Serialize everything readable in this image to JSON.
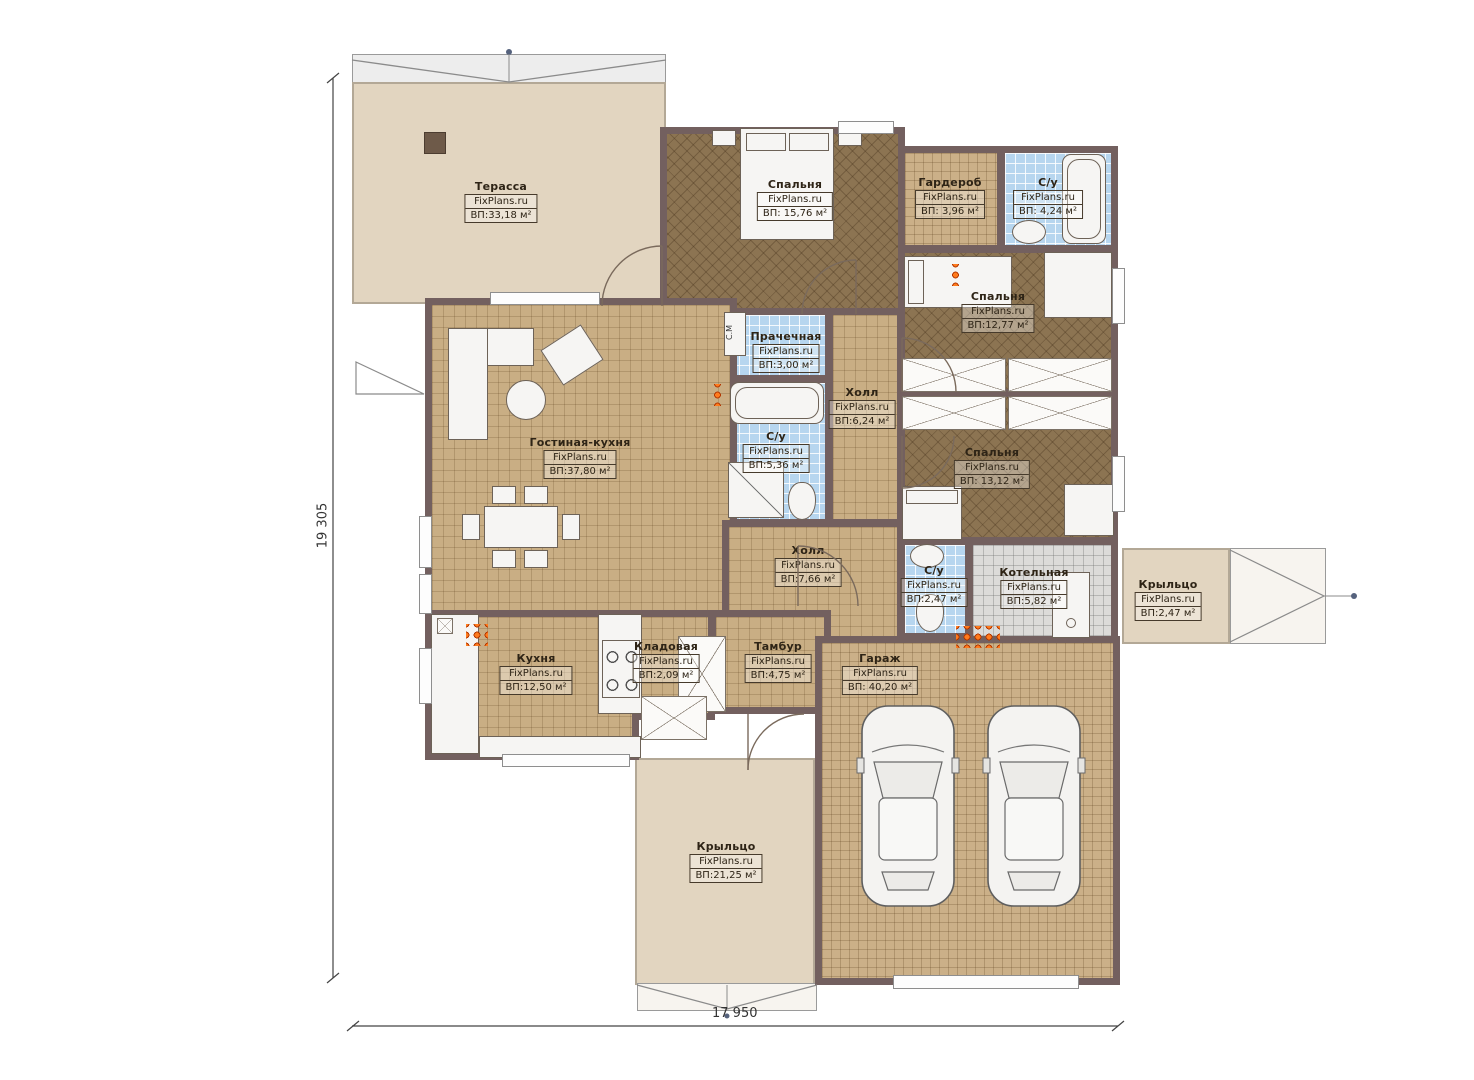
{
  "brand": "FixPlans.ru",
  "dimensions": {
    "height_label": "19 305",
    "width_label": "17 950"
  },
  "annotations": {
    "washing_machine": "С.М"
  },
  "colors": {
    "wall": "#73605f",
    "floor_tile": "#c9ae84",
    "floor_bedroom": "#8c7452",
    "floor_bath": "#b7d6ef",
    "floor_terrace": "#e2d5c0",
    "floor_boiler": "#dcdbd9",
    "radiator": "#ff7b1d"
  },
  "rooms": {
    "terrace": {
      "name": "Терасса",
      "area": "ВП:33,18 м²"
    },
    "bedroom_top": {
      "name": "Спальня",
      "area": "ВП: 15,76 м²"
    },
    "wardrobe": {
      "name": "Гардероб",
      "area": "ВП: 3,96 м²"
    },
    "bath_top": {
      "name": "С/у",
      "area": "ВП: 4,24 м²"
    },
    "bedroom_right": {
      "name": "Спальня",
      "area": "ВП:12,77 м²"
    },
    "laundry": {
      "name": "Прачечная",
      "area": "ВП:3,00 м²"
    },
    "hall_upper": {
      "name": "Холл",
      "area": "ВП:6,24 м²"
    },
    "bath_middle": {
      "name": "С/у",
      "area": "ВП:5,36 м²"
    },
    "living_kitchen": {
      "name": "Гостиная-кухня",
      "area": "ВП:37,80 м²"
    },
    "bedroom_lower": {
      "name": "Спальня",
      "area": "ВП: 13,12 м²"
    },
    "hall_lower": {
      "name": "Холл",
      "area": "ВП:7,66 м²"
    },
    "bath_small": {
      "name": "С/у",
      "area": "ВП:2,47 м²"
    },
    "boiler": {
      "name": "Котельная",
      "area": "ВП:5,82 м²"
    },
    "porch_right": {
      "name": "Крыльцо",
      "area": "ВП:2,47 м²"
    },
    "kitchen": {
      "name": "Кухня",
      "area": "ВП:12,50 м²"
    },
    "pantry": {
      "name": "Кладовая",
      "area": "ВП:2,09 м²"
    },
    "tambour": {
      "name": "Тамбур",
      "area": "ВП:4,75 м²"
    },
    "garage": {
      "name": "Гараж",
      "area": "ВП: 40,20 м²"
    },
    "porch_bottom": {
      "name": "Крыльцо",
      "area": "ВП:21,25 м²"
    }
  }
}
